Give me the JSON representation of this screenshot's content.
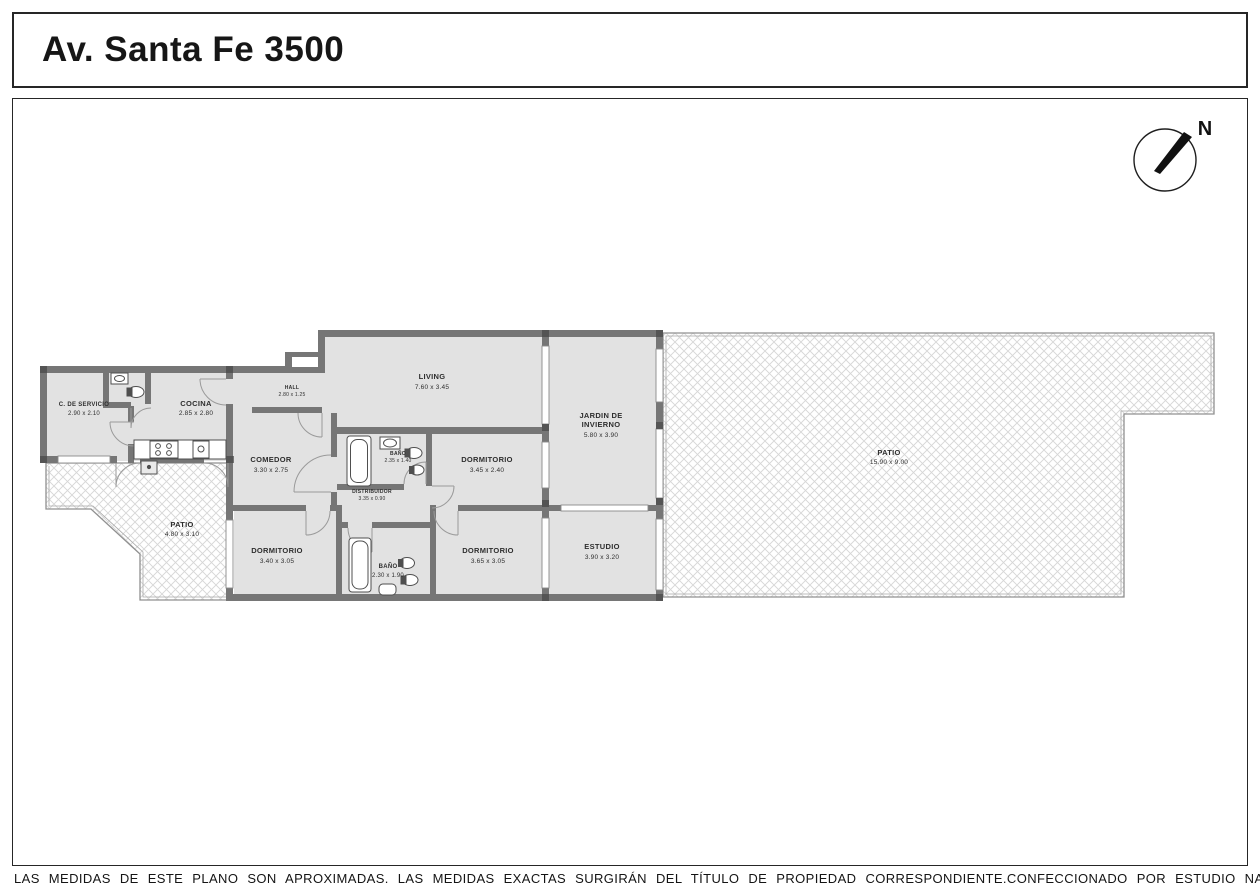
{
  "title": "Av. Santa Fe 3500",
  "compass": {
    "label": "N"
  },
  "footer": {
    "disclaimer": "LAS MEDIDAS DE ESTE PLANO SON APROXIMADAS. LAS MEDIDAS EXACTAS SURGIRÁN DEL TÍTULO DE PROPIEDAD CORRESPONDIENTE.",
    "credit": "CONFECCIONADO POR ESTUDIO NARTEX"
  },
  "colors": {
    "wall": "#767676",
    "room_fill": "#e2e2e2",
    "hatch_line": "#d6d6d6",
    "patio_border": "#909090",
    "frame": "#262626"
  },
  "rooms": {
    "servicio": {
      "name": "C. DE SERVICIO",
      "dims": "2.90 x 2.10"
    },
    "cocina": {
      "name": "COCINA",
      "dims": "2.85 x 2.80"
    },
    "hall": {
      "name": "HALL",
      "dims": "2.80 x 1.25"
    },
    "comedor": {
      "name": "COMEDOR",
      "dims": "3.30 x 2.75"
    },
    "living": {
      "name": "LIVING",
      "dims": "7.60 x 3.45"
    },
    "jardin": {
      "name_line1": "JARDIN DE",
      "name_line2": "INVIERNO",
      "dims": "5.80 x 3.90"
    },
    "patio_chico": {
      "name": "PATIO",
      "dims": "4.80 x 3.10"
    },
    "patio_grande": {
      "name": "PATIO",
      "dims": "15.90 x 9.00"
    },
    "dormitorio_1": {
      "name": "DORMITORIO",
      "dims": "3.45 x 2.40"
    },
    "dormitorio_2": {
      "name": "DORMITORIO",
      "dims": "3.40 x 3.05"
    },
    "dormitorio_3": {
      "name": "DORMITORIO",
      "dims": "3.65 x 3.05"
    },
    "estudio": {
      "name": "ESTUDIO",
      "dims": "3.90 x 3.20"
    },
    "bano_1": {
      "name": "BAÑO",
      "dims": "2.35 x 1.40"
    },
    "bano_2": {
      "name": "BAÑO",
      "dims": "2.30 x 1.90"
    },
    "distribuidor": {
      "name": "DISTRIBUIDOR",
      "dims": "3.35 x 0.90"
    }
  }
}
